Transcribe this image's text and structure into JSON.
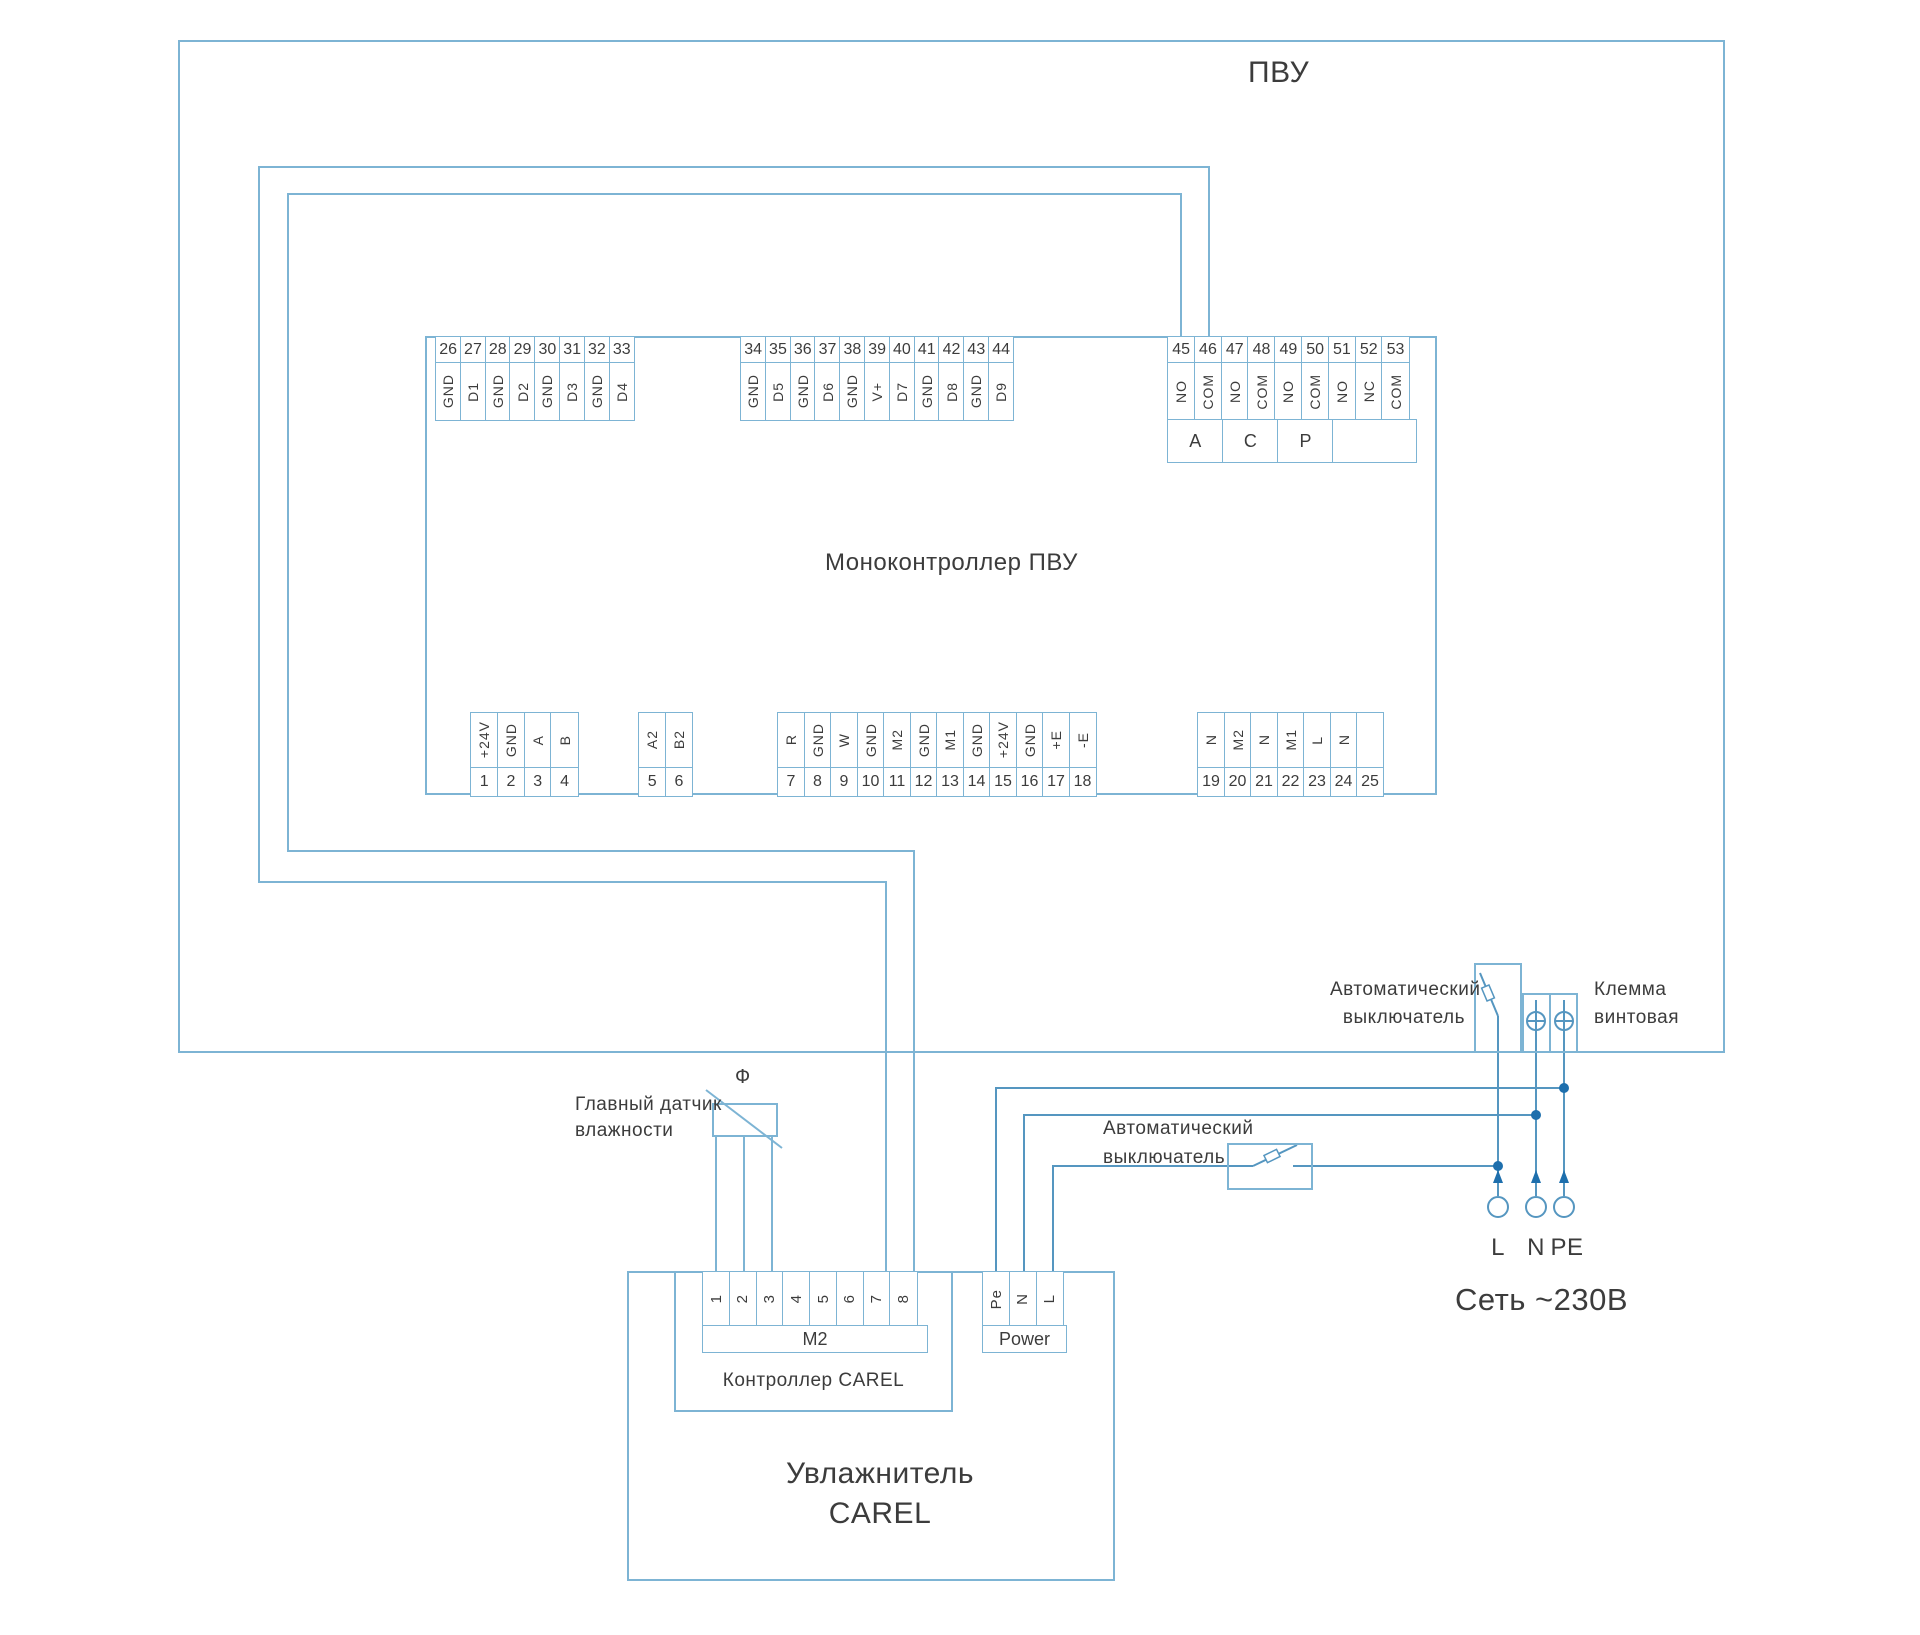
{
  "colors": {
    "line": "#7db4d4",
    "wire": "#5596c0",
    "dot": "#1e6fad",
    "text": "#3c3c3c"
  },
  "pvu": {
    "title": "ПВУ"
  },
  "monocontroller": {
    "label": "Моноконтроллер ПВУ",
    "top_blocks": [
      {
        "numbers": [
          "26",
          "27",
          "28",
          "29",
          "30",
          "31",
          "32",
          "33"
        ],
        "labels": [
          "GND",
          "D1",
          "GND",
          "D2",
          "GND",
          "D3",
          "GND",
          "D4"
        ]
      },
      {
        "numbers": [
          "34",
          "35",
          "36",
          "37",
          "38",
          "39",
          "40",
          "41",
          "42",
          "43",
          "44"
        ],
        "labels": [
          "GND",
          "D5",
          "GND",
          "D6",
          "GND",
          "V+",
          "D7",
          "GND",
          "D8",
          "GND",
          "D9"
        ]
      },
      {
        "numbers": [
          "45",
          "46",
          "47",
          "48",
          "49",
          "50",
          "51",
          "52",
          "53"
        ],
        "labels": [
          "NO",
          "COM",
          "NO",
          "COM",
          "NO",
          "COM",
          "NO",
          "NC",
          "COM"
        ],
        "groups": [
          {
            "label": "A",
            "span": 2
          },
          {
            "label": "C",
            "span": 2
          },
          {
            "label": "P",
            "span": 2
          },
          {
            "label": "",
            "span": 3
          }
        ]
      }
    ],
    "bottom_blocks": [
      {
        "numbers": [
          "1",
          "2",
          "3",
          "4"
        ],
        "labels": [
          "+24V",
          "GND",
          "A",
          "B"
        ]
      },
      {
        "numbers": [
          "5",
          "6"
        ],
        "labels": [
          "A2",
          "B2"
        ]
      },
      {
        "numbers": [
          "7",
          "8",
          "9",
          "10",
          "11",
          "12",
          "13",
          "14",
          "15",
          "16",
          "17",
          "18"
        ],
        "labels": [
          "R",
          "GND",
          "W",
          "GND",
          "M2",
          "GND",
          "M1",
          "GND",
          "+24V",
          "GND",
          "+E",
          "-E"
        ]
      },
      {
        "numbers": [
          "19",
          "20",
          "21",
          "22",
          "23",
          "24",
          "25"
        ],
        "labels": [
          "N",
          "M2",
          "N",
          "M1",
          "L",
          "N",
          ""
        ]
      }
    ]
  },
  "breaker_main": {
    "label_line1": "Автоматический",
    "label_line2": "выключатель"
  },
  "screw_terminal": {
    "label_line1": "Клемма",
    "label_line2": "винтовая"
  },
  "breaker_humidifier": {
    "label_line1": "Автоматический",
    "label_line2": "выключатель"
  },
  "humidity_sensor": {
    "label_line1": "Главный датчик",
    "label_line2": "влажности",
    "symbol": "Ф"
  },
  "humidifier": {
    "name_line1": "Увлажнитель",
    "name_line2": "CAREL",
    "controller_label": "Контроллер CAREL",
    "m2_block": {
      "numbers": [
        "1",
        "2",
        "3",
        "4",
        "5",
        "6",
        "7",
        "8"
      ],
      "label": "M2"
    },
    "power_block": {
      "labels": [
        "Pe",
        "N",
        "L"
      ],
      "label": "Power"
    }
  },
  "mains": {
    "terminals": [
      "L",
      "N",
      "PE"
    ],
    "label": "Сеть ~230В"
  }
}
